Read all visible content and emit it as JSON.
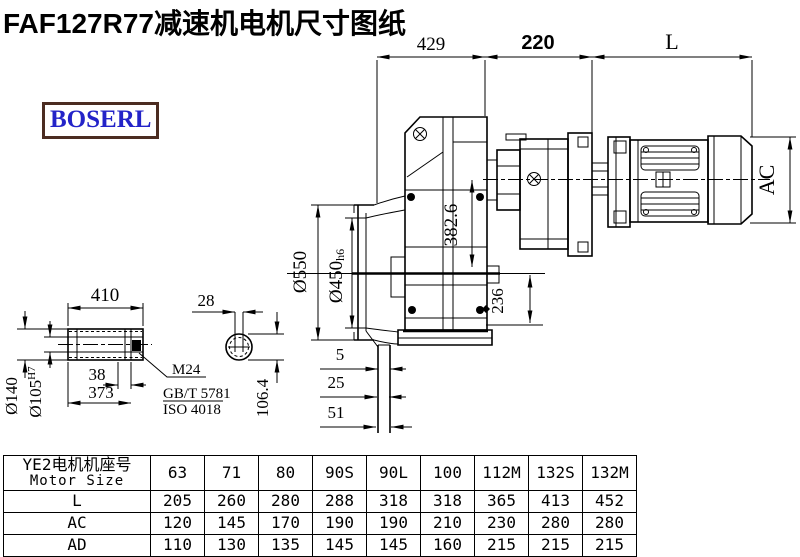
{
  "title": "FAF127R77减速机电机尺寸图纸",
  "brand": {
    "label": "BOSERL",
    "border_color": "#4b2c21",
    "text_color": "#2323c8"
  },
  "drawing": {
    "dims": {
      "top_429": "429",
      "top_220": "220",
      "top_L": "L",
      "ac": "AC",
      "d550": "Ø550",
      "d450": "Ø450",
      "d450_tol": "h6",
      "v382": "382.6",
      "v236": "236",
      "shaft_len": "410",
      "key_len": "38",
      "shaft_inner": "373",
      "d140": "Ø140",
      "d105": "Ø105",
      "d105_tol": "H7",
      "key_w": "28",
      "key_h": "106.4",
      "off_5": "5",
      "off_25": "25",
      "off_51": "51",
      "thread": "M24",
      "std1": "GB/T 5781",
      "std2": "ISO 4018"
    }
  },
  "table": {
    "header": {
      "line1": "YE2电机机座号",
      "line2": "Motor Size",
      "cols": [
        "63",
        "71",
        "80",
        "90S",
        "90L",
        "100",
        "112M",
        "132S",
        "132M"
      ]
    },
    "rows": [
      {
        "label": "L",
        "values": [
          "205",
          "260",
          "280",
          "288",
          "318",
          "318",
          "365",
          "413",
          "452"
        ]
      },
      {
        "label": "AC",
        "values": [
          "120",
          "145",
          "170",
          "190",
          "190",
          "210",
          "230",
          "280",
          "280"
        ]
      },
      {
        "label": "AD",
        "values": [
          "110",
          "130",
          "135",
          "145",
          "145",
          "160",
          "215",
          "215",
          "215"
        ]
      }
    ]
  }
}
